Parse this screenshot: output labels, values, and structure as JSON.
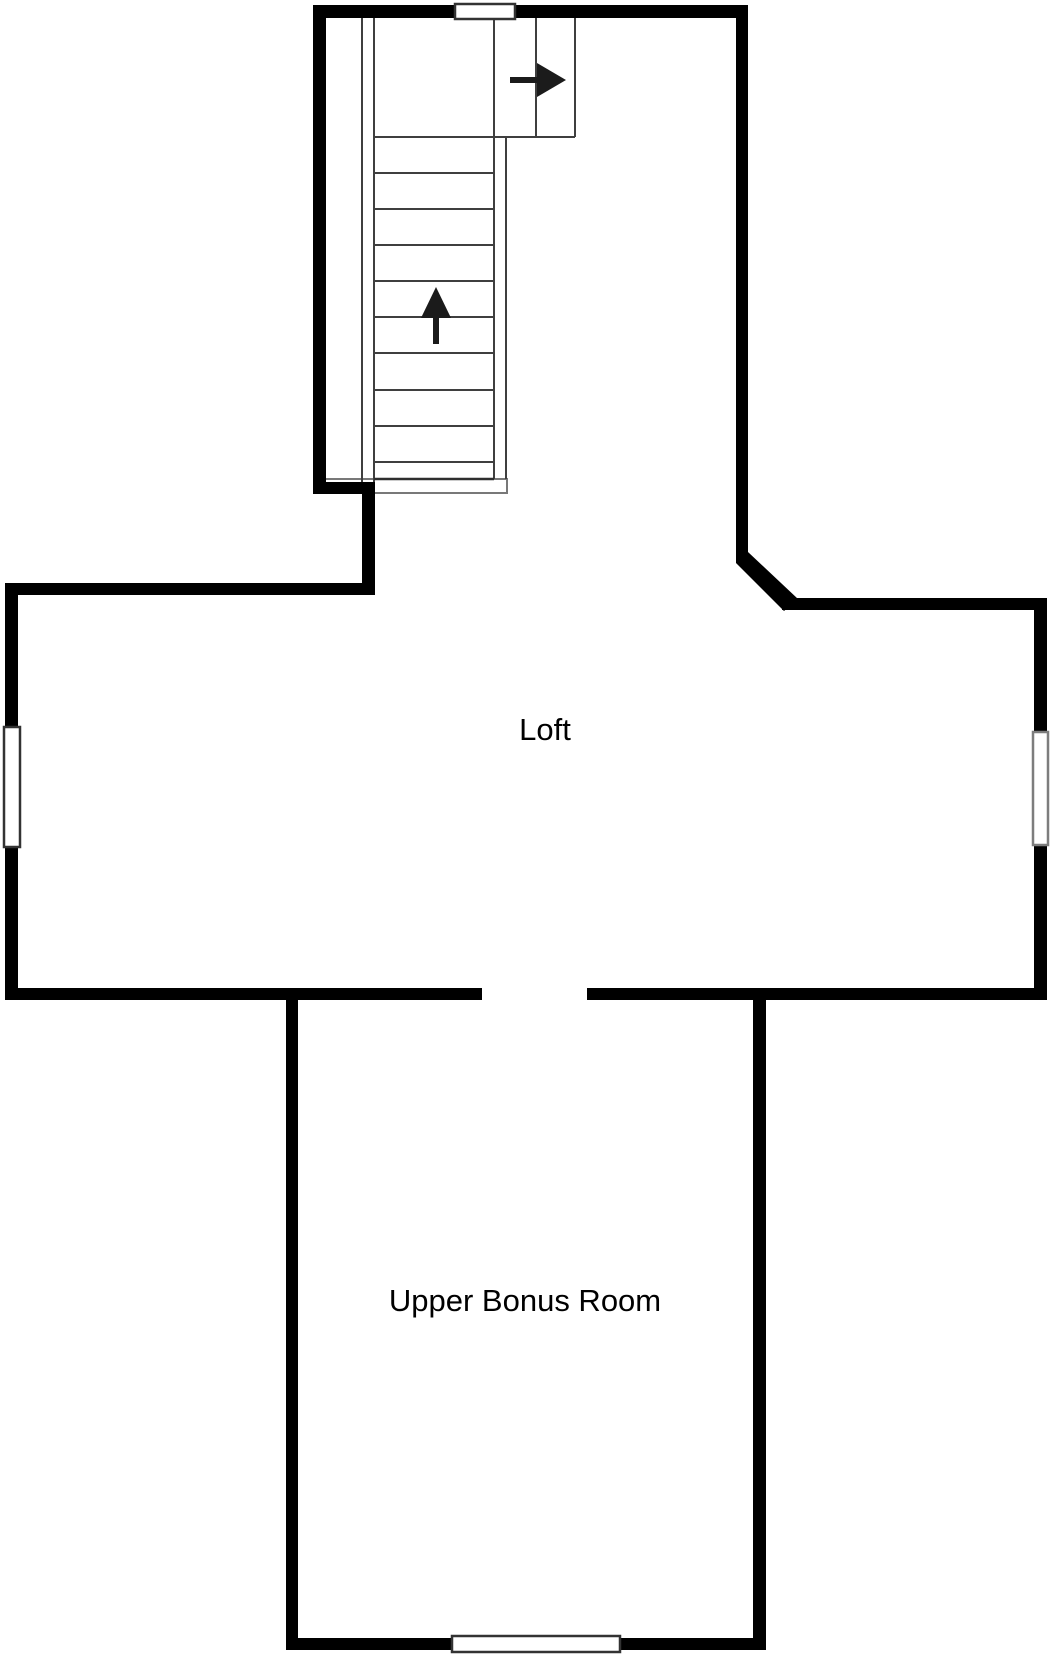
{
  "page": {
    "background": "#ffffff",
    "type_label": "floor plan"
  },
  "floor_plan": {
    "rooms": [
      {
        "id": "loft",
        "label": "Loft"
      },
      {
        "id": "upper-bonus-room",
        "label": "Upper Bonus Room"
      }
    ],
    "staircase": {
      "tread_count": 10,
      "icons": [
        {
          "name": "stairs-up-arrow-icon",
          "glyph": "↑",
          "meaning": "stairs ascend upward"
        },
        {
          "name": "stairs-exit-right-arrow-icon",
          "glyph": "→",
          "meaning": "landing exit to the right"
        }
      ]
    },
    "colors": {
      "wall": "#000000",
      "stair_line": "#3f3f3f",
      "stair_base_border": "#787878",
      "window_border_dark": "#333333",
      "window_border_grey": "#7d7d7d",
      "arrow": "#1b1b1b",
      "label_text": "#000000",
      "background": "#ffffff"
    }
  }
}
